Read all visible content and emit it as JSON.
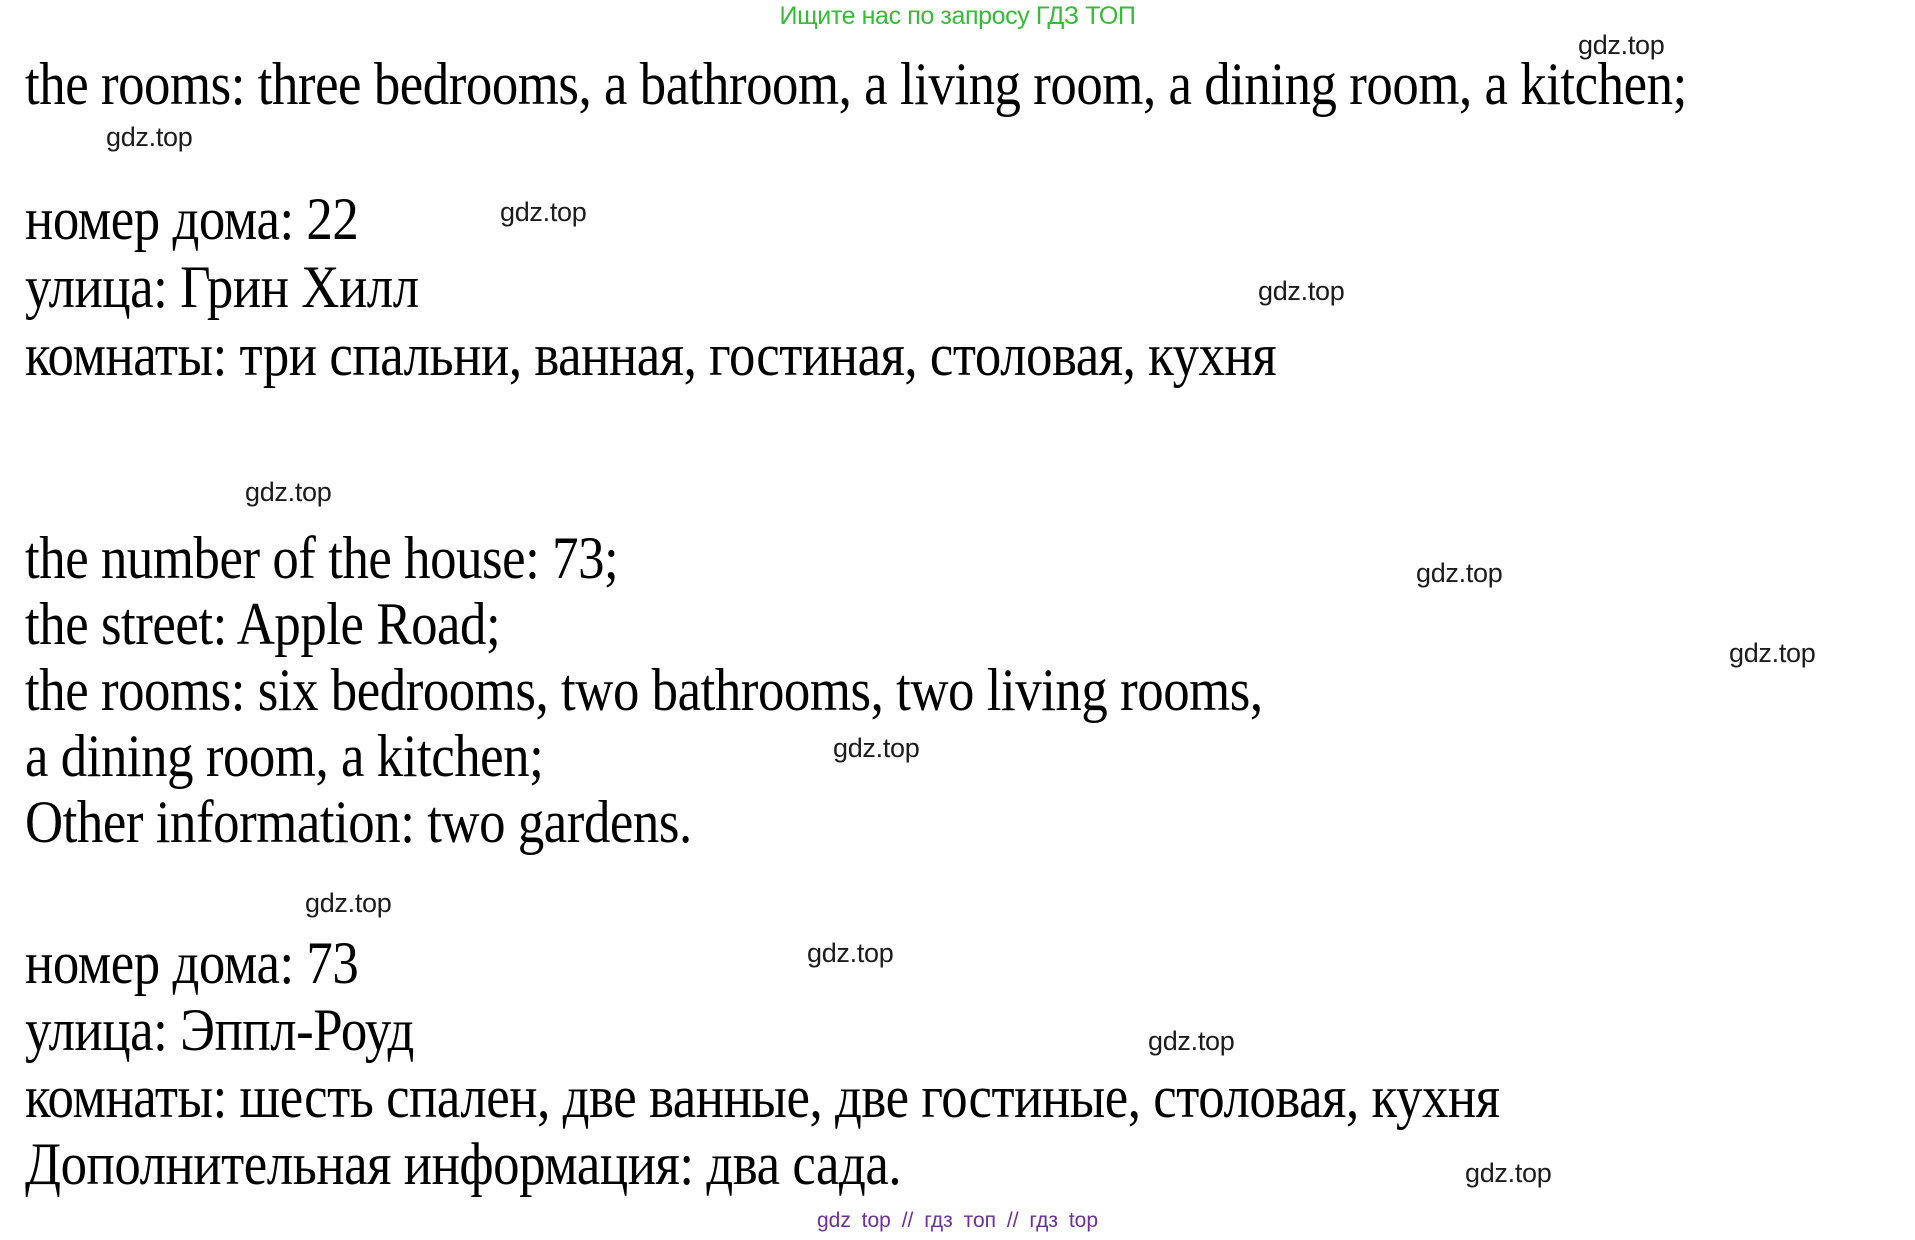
{
  "page": {
    "background_color": "#ffffff",
    "text_color": "#000000"
  },
  "header": {
    "promo_text": "Ищите нас по запросу ГДЗ ТОП",
    "promo_color": "#33bd37"
  },
  "content": {
    "sections": [
      {
        "language": "english",
        "lines": [
          "the rooms: three bedrooms, a bathroom, a living room, a dining room, a kitchen;"
        ]
      },
      {
        "language": "russian",
        "lines": [
          "номер дома: 22",
          "улица: Грин Хилл",
          "комнаты: три спальни, ванная, гостиная, столовая, кухня"
        ]
      },
      {
        "language": "english",
        "lines": [
          "the number of the house: 73;",
          "the street: Apple Road;",
          "the rooms: six bedrooms, two bathrooms, two living rooms,",
          "a dining room, a kitchen;",
          "Other information: two gardens."
        ]
      },
      {
        "language": "russian",
        "lines": [
          "номер дома: 73",
          "улица: Эппл-Роуд",
          "комнаты: шесть спален, две ванные, две гостиные, столовая, кухня",
          "Дополнительная информация: два сада."
        ]
      }
    ]
  },
  "watermark": {
    "label": "gdz.top",
    "color": "#1c1c1c"
  },
  "footer": {
    "text": "gdz top // гдз топ // гдз top",
    "color": "#6e2f9b"
  }
}
